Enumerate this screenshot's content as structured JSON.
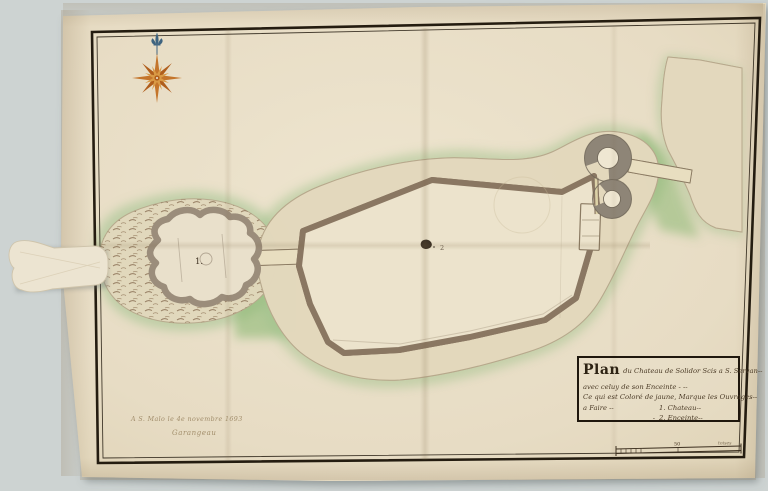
{
  "map": {
    "labels": {
      "fort": "1.",
      "enceinte": "2"
    },
    "annotations": {
      "date_place": "A S. Malo le 4e novembre 1693",
      "signature": "Garangeau"
    },
    "cartouche": {
      "title_word": "Plan",
      "title_rest": "du Chateau de Solidor Scis a S. Servan--",
      "line2": "avec celuy de son Enceinte - --",
      "line3": "Ce qui est Coloré de jaune, Marque les Ouvrages--",
      "legend_rows": [
        {
          "left": "a Faire --",
          "dash": "",
          "item": "1. Chateau--"
        },
        {
          "left": "",
          "dash": "-",
          "item": "2. Enceinte--"
        }
      ]
    },
    "scale_bar": {
      "mid": "50",
      "unit": "toises"
    },
    "icons": {
      "compass": "compass-rose",
      "north": "fleur-de-lis"
    },
    "colors": {
      "backdrop": "#cdd3d2",
      "paper": "#e7ddc6",
      "frame": "#241c10",
      "ink": "#3b2e1e",
      "rock": "#8b7257",
      "wall_edge": "#8a7762",
      "wall_fill": "#ddd2a8",
      "green": "#9fc18c",
      "tower": "#8e8577",
      "compass_orange": "#c4752b",
      "compass_blue": "#3f6480"
    }
  }
}
